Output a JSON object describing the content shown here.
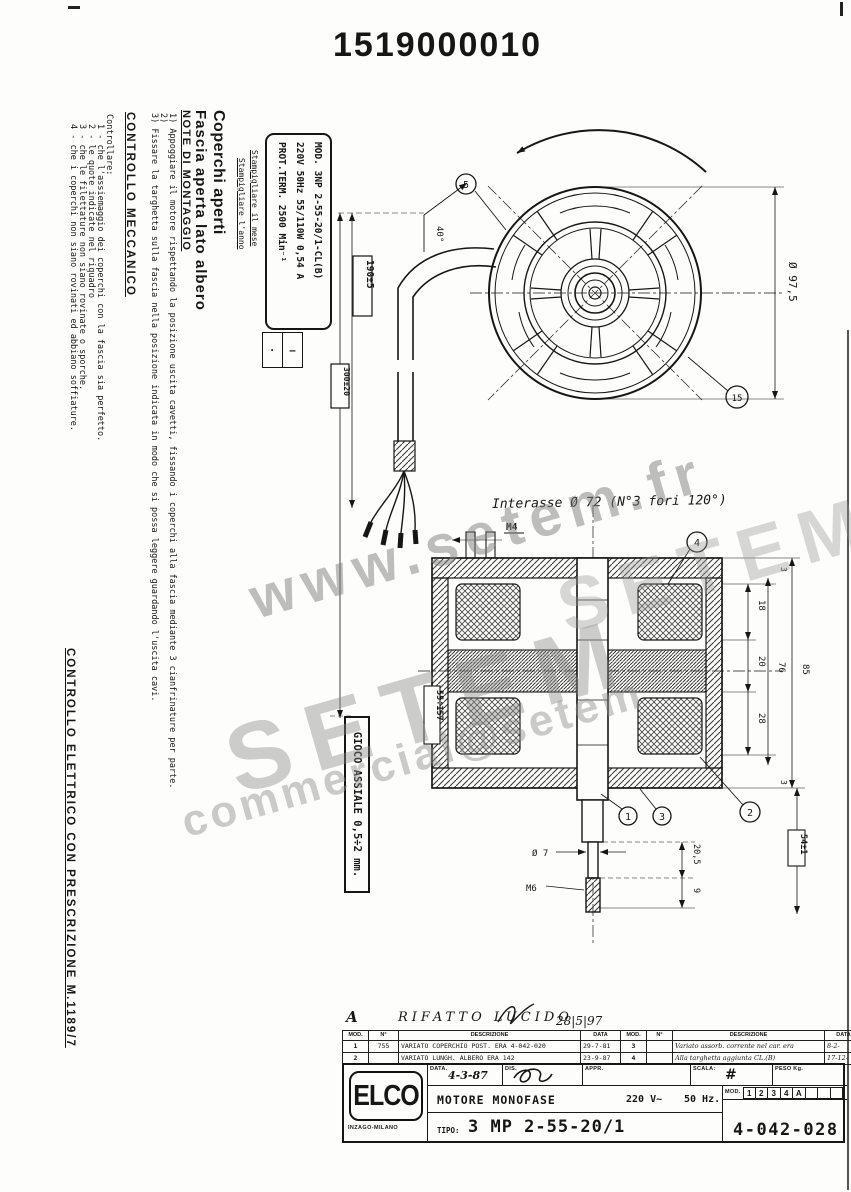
{
  "page": {
    "title": "1519000010"
  },
  "watermark": {
    "url": "www.setem.fr",
    "brand_big": "SETEM",
    "brand_small": "SETEM",
    "email": "commercial@setem"
  },
  "left_panel": {
    "heading1": "Coperchi aperti",
    "heading2": "Fascia aperta lato albero",
    "notes_title": "NOTE DI MONTAGGIO",
    "note1": "1) Appoggiare il motore rispettando la posizione uscita cavetti, fissando i coperchi alla fascia mediante 3 cianfrinature per parte.",
    "note2": "2)",
    "note3": "3) Fissare la targhetta sulla fascia nella posizione indicata in modo che si possa leggere guardando l'uscita cavi.",
    "stamp_note_month": "Stampigliare il mese",
    "stamp_note_year": "Stampigliare l'anno",
    "mech_title": "CONTROLLO MECCANICO",
    "mech_intro": "Controllare:",
    "mech_item1": "1 - che l'assiemaggio dei coperchi con la fascia sia perfetto.",
    "mech_item2": "2 - le quote indicate nel riquadro",
    "mech_item3": "3 - che le filettature non siano rovinate o sporche.",
    "mech_item4": "4 - che i coperchi non siano rovinati ed abbiano soffiature.",
    "elec_title": "CONTROLLO ELETTRICO CON PRESCRIZIONE M.1189/7"
  },
  "nameplate": {
    "line1": "MOD. 3NP 2-55-20/1-CL(B)",
    "line2": "220V 50Hz 55/110W 0,54 A",
    "line3": "PROT.TERM.  2500 Min⁻¹",
    "stamp_cell_month": "·",
    "stamp_cell_year": "–"
  },
  "front_view": {
    "diameter": "Ø 97,5",
    "angle": "40°",
    "dim_cable_exit": "190±5",
    "dim_cable_length": "300±20",
    "balloon_top": "5",
    "balloon_bottom": "15"
  },
  "section_view": {
    "thread_top": "M4",
    "holes_note": "Interasse Ø 72 (N°3 fori 120°)",
    "balloon1": "1",
    "balloon2": "2",
    "balloon3": "3",
    "balloon4": "4",
    "dim_3_top": "3",
    "dim_18": "18",
    "dim_20": "20",
    "dim_28": "28",
    "dim_76": "76",
    "dim_85": "85",
    "dim_3_bottom": "3",
    "dim_54": "54±1",
    "dim_205": "20,5",
    "dim_9": "9",
    "dim_range": "55÷157",
    "dim_shaft": "Ø 7",
    "thread_bottom": "M6",
    "gioco": "GIOCO ASSIALE 0,5÷2 mm."
  },
  "revision_table": {
    "handwritten_rev": "A",
    "handwritten_text": "RIFATTO LUCIDO",
    "handwritten_date": "28|5|97",
    "headers": [
      "MOD.",
      "N°",
      "DESCRIZIONE",
      "DATA",
      "MOD.",
      "N°",
      "DESCRIZIONE",
      "DATA"
    ],
    "rows": [
      {
        "mod": "1",
        "n": "755",
        "descr": "VARIATO COPERCHIO POST. ERA 4-042-020",
        "data": "29-7-81",
        "mod2": "3",
        "n2": "",
        "descr2": "Variato assorb. corrente nel car. era",
        "data2": "8-2-"
      },
      {
        "mod": "2",
        "n": "",
        "descr": "VARIATO LUNGH. ALBERO ERA 142",
        "data": "23-9-87",
        "mod2": "4",
        "n2": "",
        "descr2": "Alla targhetta aggiunta CL.(B)",
        "data2": "17-12-"
      }
    ]
  },
  "title_block": {
    "logo": "ELCO",
    "logo_sub": "INZAGO-MILANO",
    "data_label": "DATA.",
    "data_value": "4-3-87",
    "dis_label": "DIS.",
    "appr_label": "APPR.",
    "scala_label": "SCALA:",
    "scala_value": "#",
    "peso_label": "PESO Kg.",
    "product": "MOTORE MONOFASE",
    "voltage": "220 V~",
    "frequency": "50 Hz.",
    "mod_label": "MOD.",
    "mod_cells": [
      "1",
      "2",
      "3",
      "4",
      "A",
      "",
      "",
      ""
    ],
    "tipo_label": "TIPO:",
    "tipo_value": "3 MP 2-55-20/1",
    "drawing_number": "4-042-028"
  }
}
